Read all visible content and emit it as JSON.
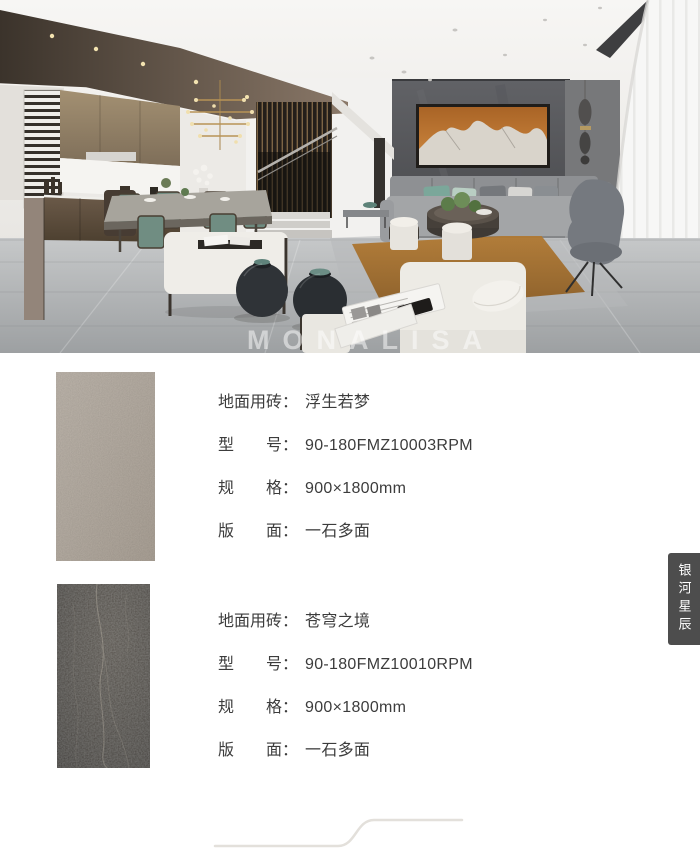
{
  "photo": {
    "watermark": "MONALISA"
  },
  "products": [
    {
      "rows": [
        {
          "label": "地面用砖",
          "value": "浮生若梦"
        },
        {
          "label": "型号",
          "value": "90-180FMZ10003RPM"
        },
        {
          "label": "规格",
          "value": "900×1800mm"
        },
        {
          "label": "版面",
          "value": "一石多面"
        }
      ]
    },
    {
      "rows": [
        {
          "label": "地面用砖",
          "value": "苍穹之境"
        },
        {
          "label": "型号",
          "value": "90-180FMZ10010RPM"
        },
        {
          "label": "规格",
          "value": "900×1800mm"
        },
        {
          "label": "版面",
          "value": "一石多面"
        }
      ]
    }
  ],
  "punctuation": {
    "colon": "："
  },
  "side_tab": {
    "label": "银河星辰"
  },
  "colors": {
    "spec_text": "#3c3c3c",
    "tab_bg": "#4d4d4d",
    "tab_text": "#ffffff",
    "divider": "#e3e0db",
    "tile_light": "#b7aea3",
    "tile_dark": "#39342e",
    "art_orange": "#bd7434"
  }
}
